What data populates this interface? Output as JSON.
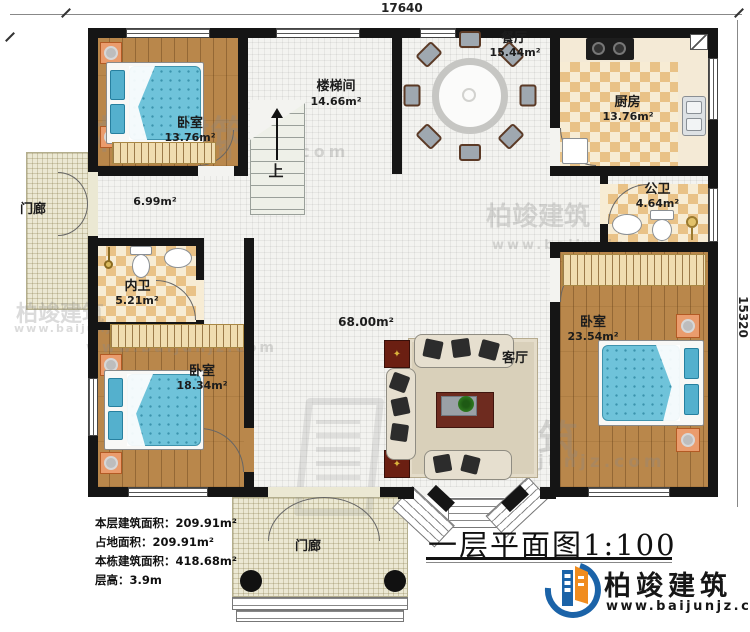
{
  "drawing": {
    "title": "一层平面图1:100",
    "dimensions": {
      "top": "17640",
      "right": "15320"
    }
  },
  "rooms": {
    "bedroom_tl": {
      "name": "卧室",
      "area": "13.76m²"
    },
    "stairwell": {
      "name": "楼梯间",
      "area": "14.66m²"
    },
    "dining": {
      "name": "餐厅",
      "area": "15.44m²"
    },
    "kitchen": {
      "name": "厨房",
      "area": "13.76m²"
    },
    "bath_public": {
      "name": "公卫",
      "area": "4.64m²"
    },
    "porch_left": {
      "name": "门廊"
    },
    "hallway": {
      "area": "6.99m²"
    },
    "bath_private": {
      "name": "内卫",
      "area": "5.21m²"
    },
    "living": {
      "name": "客厅",
      "area": "68.00m²"
    },
    "bedroom_bl": {
      "name": "卧室",
      "area": "18.34m²"
    },
    "bedroom_r": {
      "name": "卧室",
      "area": "23.54m²"
    },
    "porch_bottom": {
      "name": "门廊"
    },
    "stairs": {
      "up_label": "上"
    }
  },
  "info": {
    "lines": [
      "本层建筑面积：209.91m²",
      "占地面积：209.91m²",
      "本栋建筑面积：418.68m²",
      "层高：3.9m"
    ]
  },
  "brand": {
    "name": "柏竣建筑",
    "url": "www.baijunjz.com"
  },
  "watermark": {
    "name": "柏竣建筑",
    "url": "www.baijunjz.com"
  },
  "colors": {
    "wall": "#151515",
    "wood_floor": "#b9874b",
    "tile_checker": "#e9c287",
    "bed_blue": "#6fc3da",
    "brand_blue": "#1b63a8",
    "brand_orange": "#f08c1e"
  }
}
